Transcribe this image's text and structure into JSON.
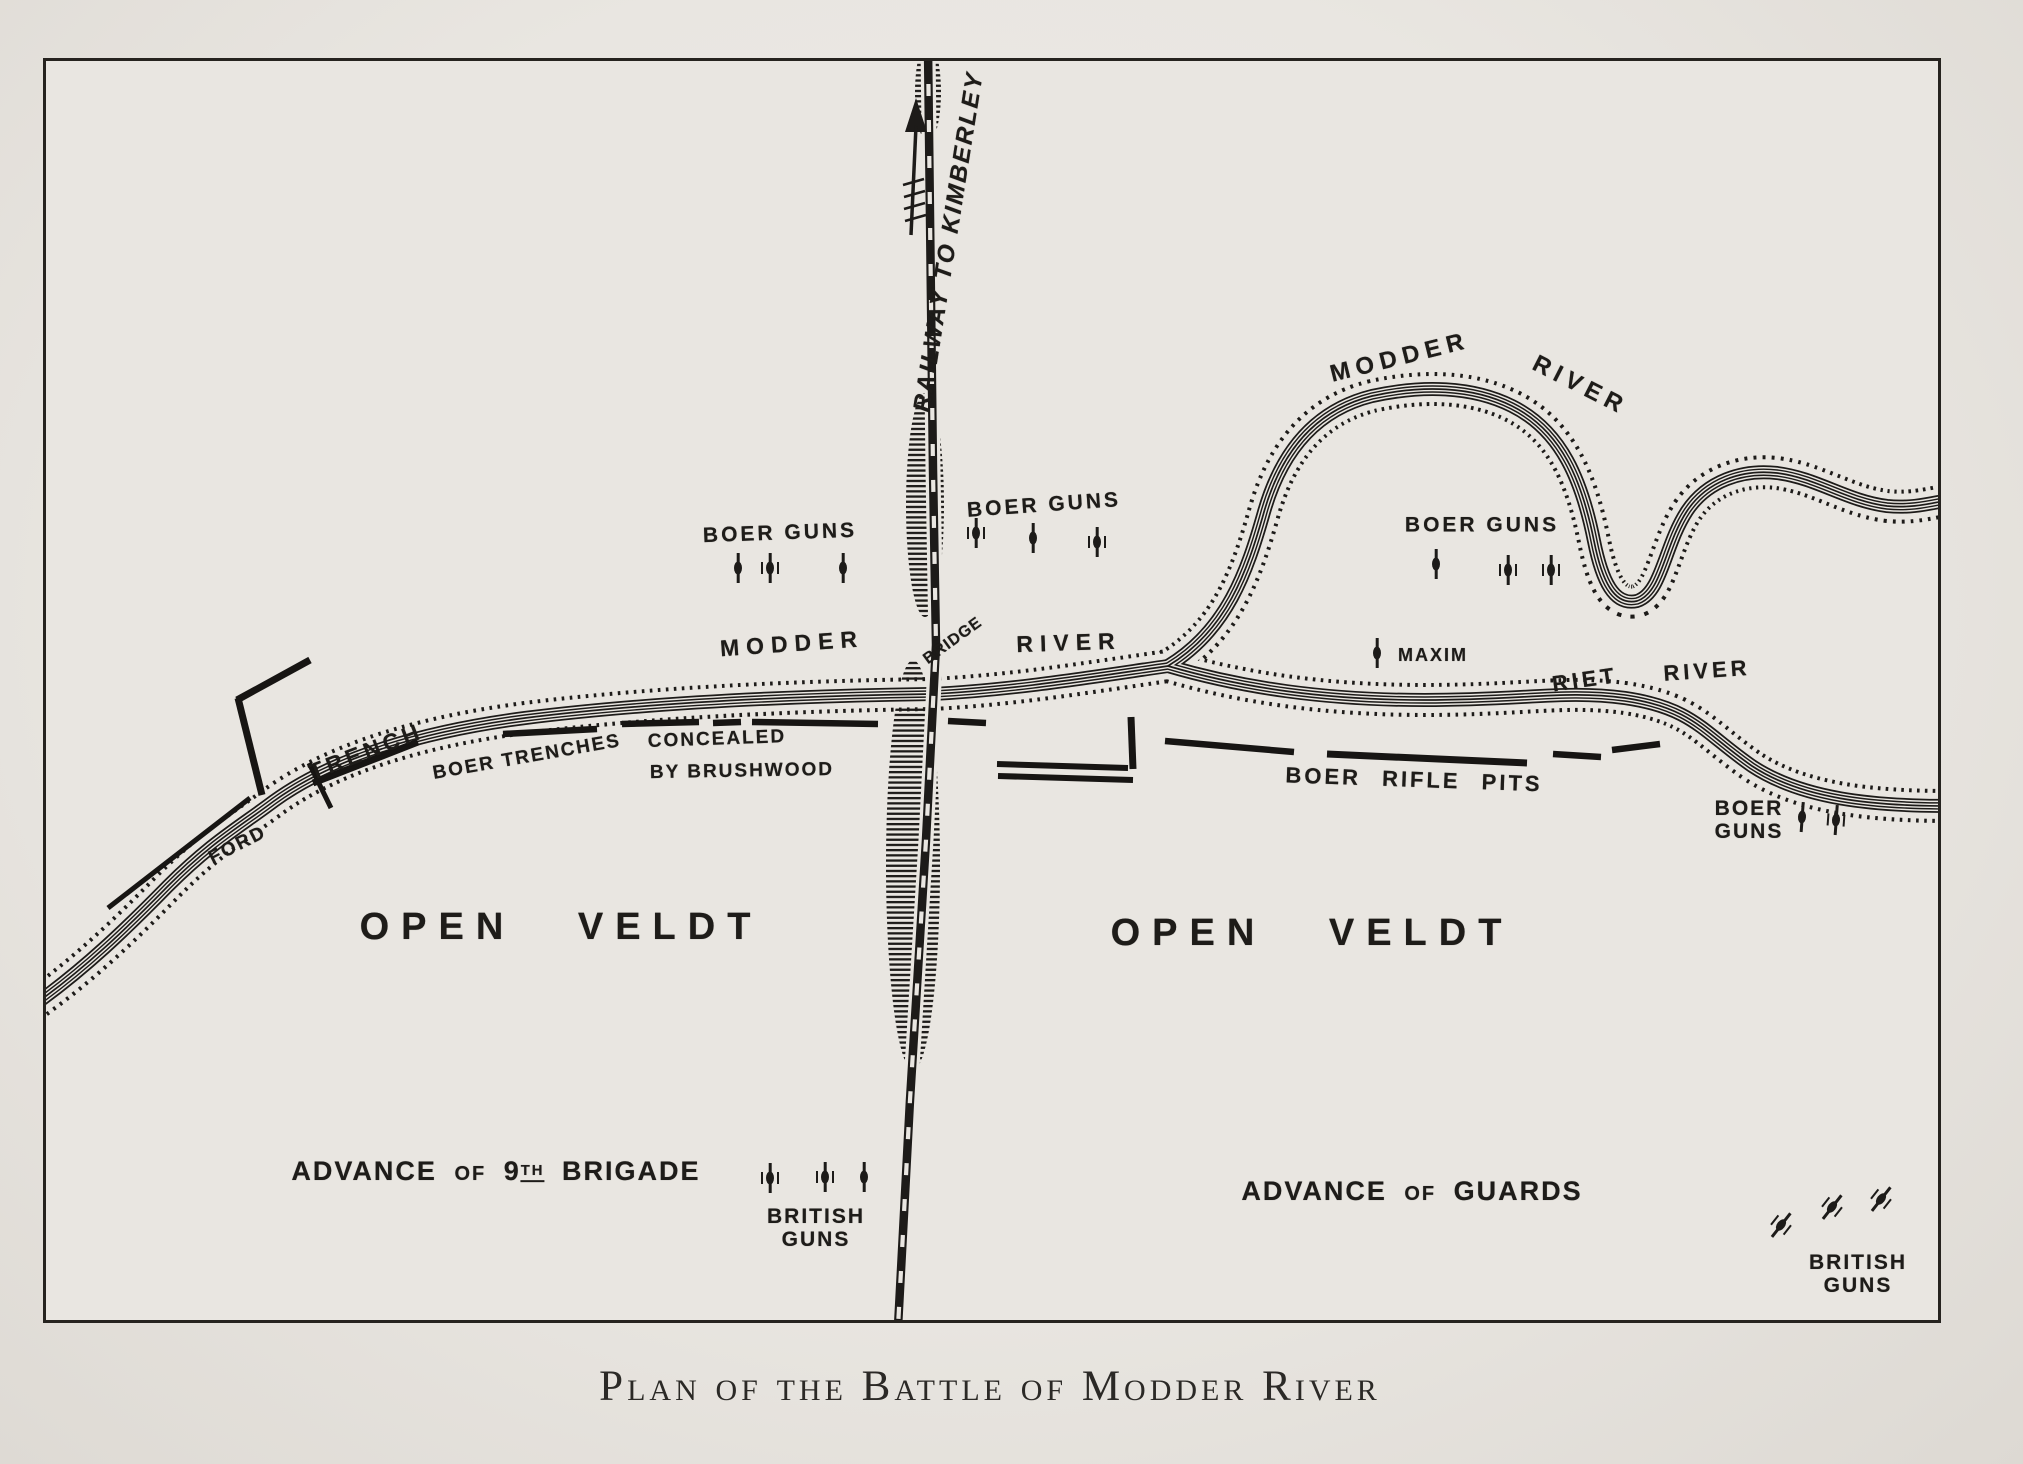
{
  "caption": "Plan of the Battle of Modder River",
  "labels": {
    "railway": "RAILWAY TO KIMBERLEY",
    "modder": "MODDER",
    "river": "RIVER",
    "riet": "RIET",
    "bridge": "BRIDGE",
    "boer_guns": "BOER GUNS",
    "boer": "BOER",
    "guns": "GUNS",
    "trench": "TRENCH",
    "ford": "FORD",
    "boer_trenches": "BOER TRENCHES",
    "concealed": "CONCEALED",
    "by_brushwood": "BY BRUSHWOOD",
    "maxim": "MAXIM",
    "boer_rifle_pits": "BOER RIFLE PITS",
    "open_veldt": "OPEN VELDT",
    "advance": "ADVANCE",
    "of": "OF",
    "nine": "9",
    "th": "TH",
    "brigade": "BRIGADE",
    "guards": "GUARDS",
    "british": "BRITISH"
  },
  "symbols": {
    "gun_icon": "artillery-gun",
    "arrow_icon": "railway-direction-arrow"
  },
  "colors": {
    "paper": "#e9e6e1",
    "ink": "#1d1b19"
  }
}
